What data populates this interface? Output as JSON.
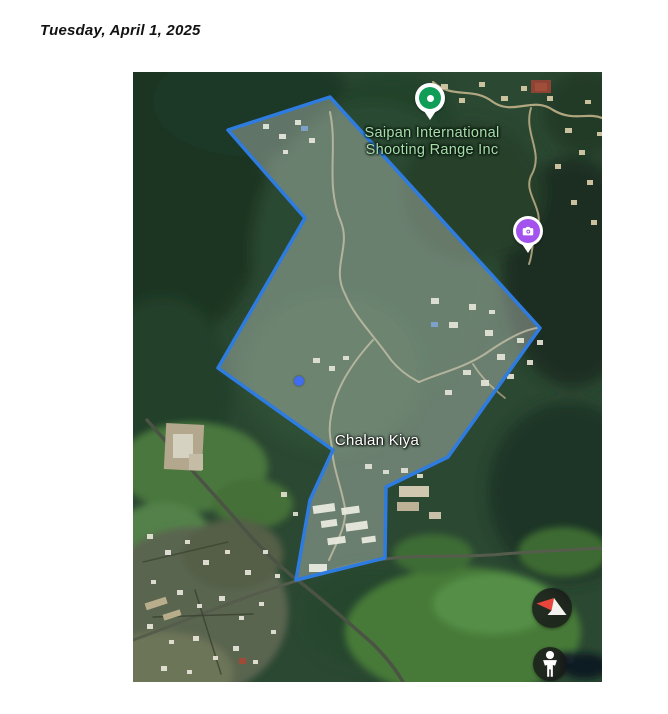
{
  "page": {
    "date_header": "Tuesday, April 1, 2025"
  },
  "map": {
    "poi_label_line1": "Saipan International",
    "poi_label_line2": "Shooting Range Inc",
    "locality_label": "Chalan Kiya",
    "boundary_points": [
      [
        197,
        25
      ],
      [
        95,
        58
      ],
      [
        172,
        146
      ],
      [
        85,
        296
      ],
      [
        200,
        378
      ],
      [
        177,
        428
      ],
      [
        163,
        508
      ],
      [
        252,
        486
      ],
      [
        253,
        415
      ],
      [
        315,
        385
      ],
      [
        407,
        256
      ]
    ],
    "colors": {
      "boundary_stroke": "#2e7ce0",
      "boundary_fill": "rgba(229,234,228,0.34)",
      "poi_pin": "#0f9d58",
      "camera_pin": "#a352ee",
      "poi_label": "#a8dcab",
      "locality_label": "#ffffff",
      "location_dot": "#3e6cf2",
      "compass_needle_red": "#e8453c",
      "control_background": "rgba(24,24,24,0.84)"
    },
    "icons": {
      "poi_pin": "map-pin-icon",
      "camera_pin": "camera-icon",
      "compass": "compass-icon",
      "pegman": "pegman-icon",
      "location": "location-dot-icon"
    }
  }
}
